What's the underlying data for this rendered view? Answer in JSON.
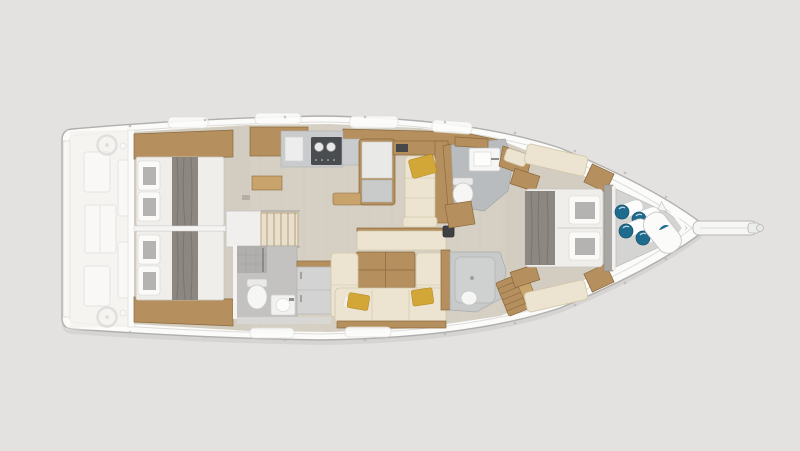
{
  "scene": {
    "title": "Sailing yacht interior layout plan — top-down view, bow to the right",
    "type": "yacht-floorplan-render",
    "orientation": "bow-right",
    "visible_text": []
  },
  "colors": {
    "bg": "#e3e2e0",
    "hull": "#fbfbfa",
    "hull-line": "#b0afad",
    "hull-trim": "#dddcd9",
    "floor": "#d6d0c4",
    "floor-aft": "#cfc9be",
    "wood": "#b58f5e",
    "wood-dark": "#8a6a3e",
    "mattress": "#efeeeb",
    "blanket": "#8d8781",
    "sofa": "#ece4d1",
    "sofa-edge": "#d2c7ab",
    "accent-yellow": "#d2a637",
    "counter": "#c9cbcd",
    "stove": "#4a4d50",
    "head-floor": "#b9bcbe",
    "shower-floor": "#c7cac9",
    "fixture": "#f6f6f5",
    "accent-teal": "#1e6b8e",
    "ghost-fill": "#f6f5f2",
    "ghost-line": "#d2d0cd",
    "locker": "#d4d4d2",
    "bulkhead": "#a9a7a4"
  },
  "areas": {
    "cockpit": {
      "fixtures": [
        "helm-wheel-port",
        "helm-wheel-starboard",
        "helm-seat-port",
        "helm-seat-starboard",
        "cockpit-table",
        "transom-platform"
      ]
    },
    "aft_cabin_port": {
      "fixtures": [
        "double-berth",
        "pillows",
        "blanket-runner",
        "hull-shelf",
        "wardrobe"
      ]
    },
    "aft_cabin_starboard": {
      "fixtures": [
        "double-berth",
        "pillows",
        "blanket-runner",
        "hull-shelf"
      ]
    },
    "companionway": {
      "fixtures": [
        "engine-box",
        "stairs"
      ]
    },
    "aft_head": {
      "fixtures": [
        "shower-corner",
        "toilet",
        "washbasin",
        "cabinet"
      ]
    },
    "galley": {
      "fixtures": [
        "sink-counter",
        "stove",
        "island-counter",
        "chart-counter"
      ]
    },
    "salon": {
      "fixtures": [
        "chaise-longue",
        "yellow-cushions",
        "dinette-table",
        "u-shaped-sofa",
        "bench-seat",
        "mast-post"
      ]
    },
    "forward_head": {
      "fixtures": [
        "washbasin",
        "toilet",
        "wood-bench"
      ]
    },
    "forward_shower": {
      "fixtures": [
        "shower-tray",
        "teak-bench"
      ]
    },
    "forward_cabin": {
      "fixtures": [
        "island-double-berth",
        "pillows",
        "blanket-runner",
        "nightstands",
        "hull-benches"
      ]
    },
    "bow_locker": {
      "fixtures": [
        "fenders",
        "sail-bag"
      ],
      "fender_count": 4
    },
    "bow": {
      "fixtures": [
        "bowsprit",
        "anchor-roller"
      ]
    }
  }
}
